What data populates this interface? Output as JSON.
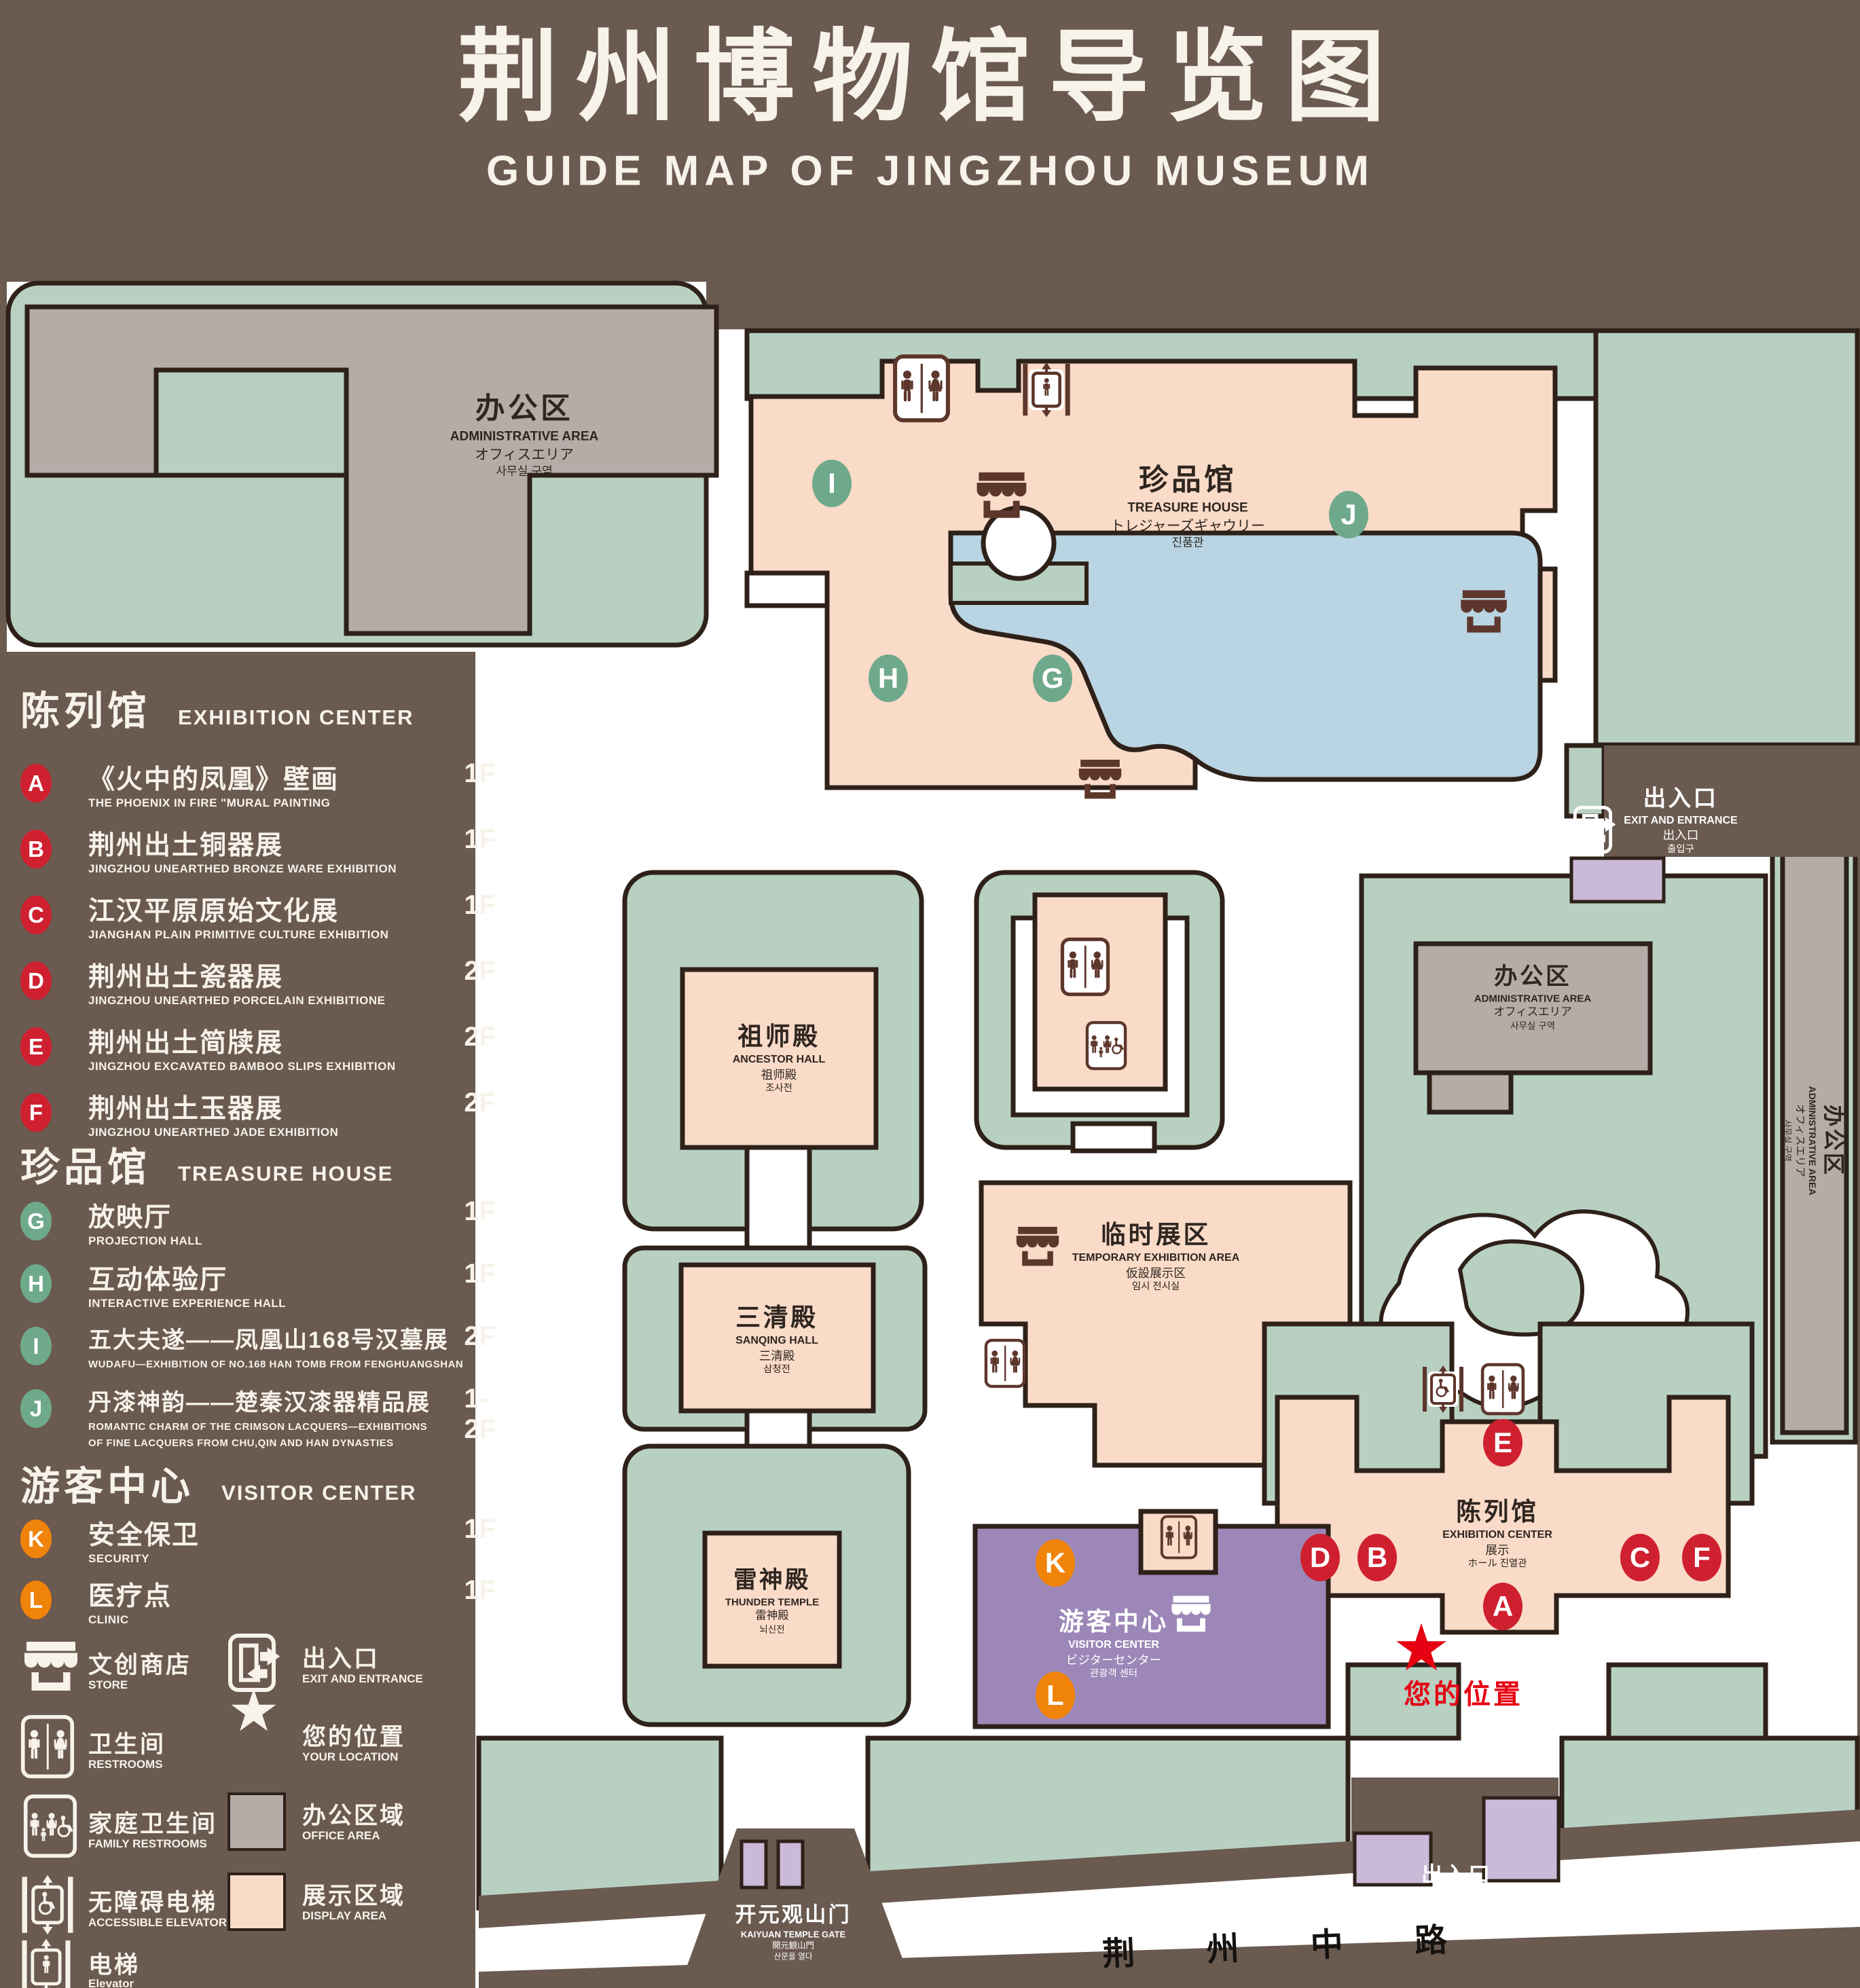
{
  "title": {
    "zh": "荆州博物馆导览图",
    "en": "GUIDE MAP OF JINGZHOU MUSEUM"
  },
  "colors": {
    "background": "#6a5a50",
    "map_green": "#b7d0c2",
    "display_area": "#f9dbc8",
    "office_area": "#b5aca8",
    "water": "#b9d4e2",
    "visitor_purple": "#9c87b8",
    "booth_purple": "#cbb9d8",
    "marker_red": "#cf2030",
    "marker_green": "#6fa98c",
    "marker_orange": "#f0830a",
    "location_red": "#e60012",
    "outline": "#2e2119"
  },
  "legend": {
    "sections": [
      {
        "zh": "陈列馆",
        "en": "EXHIBITION CENTER",
        "items": [
          {
            "letter": "A",
            "zh": "《火中的凤凰》壁画",
            "en": "THE PHOENIX IN FIRE \"MURAL PAINTING",
            "floor": "1F"
          },
          {
            "letter": "B",
            "zh": "荆州出土铜器展",
            "en": "JINGZHOU UNEARTHED BRONZE WARE EXHIBITION",
            "floor": "1F"
          },
          {
            "letter": "C",
            "zh": "江汉平原原始文化展",
            "en": "JIANGHAN PLAIN PRIMITIVE CULTURE EXHIBITION",
            "floor": "1F"
          },
          {
            "letter": "D",
            "zh": "荆州出土瓷器展",
            "en": "JINGZHOU UNEARTHED PORCELAIN EXHIBITIONE",
            "floor": "2F"
          },
          {
            "letter": "E",
            "zh": "荆州出土简牍展",
            "en": "JINGZHOU EXCAVATED BAMBOO SLIPS EXHIBITION",
            "floor": "2F"
          },
          {
            "letter": "F",
            "zh": "荆州出土玉器展",
            "en": "JINGZHOU UNEARTHED JADE EXHIBITION",
            "floor": "2F"
          }
        ]
      },
      {
        "zh": "珍品馆",
        "en": "TREASURE HOUSE",
        "items": [
          {
            "letter": "G",
            "zh": "放映厅",
            "en": "PROJECTION HALL",
            "floor": "1F"
          },
          {
            "letter": "H",
            "zh": "互动体验厅",
            "en": "INTERACTIVE EXPERIENCE HALL",
            "floor": "1F"
          },
          {
            "letter": "I",
            "zh": "五大夫遂——凤凰山168号汉墓展",
            "en": "WUDAFU—EXHIBITION OF NO.168 HAN TOMB FROM FENGHUANGSHAN",
            "floor": "2F"
          },
          {
            "letter": "J",
            "zh": "丹漆神韵——楚秦汉漆器精品展",
            "en": "ROMANTIC CHARM OF THE CRIMSON LACQUERS—EXHIBITIONS\nOF FINE LACQUERS FROM CHU,QIN AND HAN DYNASTIES",
            "floor": "1-2F"
          }
        ]
      },
      {
        "zh": "游客中心",
        "en": "VISITOR CENTER",
        "items": [
          {
            "letter": "K",
            "zh": "安全保卫",
            "en": "SECURITY",
            "floor": "1F"
          },
          {
            "letter": "L",
            "zh": "医疗点",
            "en": "CLINIC",
            "floor": "1F"
          }
        ]
      }
    ],
    "icons": [
      {
        "zh": "文创商店",
        "en": "STORE"
      },
      {
        "zh": "卫生间",
        "en": "RESTROOMS"
      },
      {
        "zh": "家庭卫生间",
        "en": "FAMILY RESTROOMS"
      },
      {
        "zh": "无障碍电梯",
        "en": "ACCESSIBLE ELEVATOR"
      },
      {
        "zh": "电梯",
        "en": "Elevator"
      },
      {
        "zh": "出入口",
        "en": "EXIT AND ENTRANCE"
      },
      {
        "zh": "您的位置",
        "en": "YOUR LOCATION"
      },
      {
        "zh": "办公区域",
        "en": "OFFICE AREA"
      },
      {
        "zh": "展示区域",
        "en": "DISPLAY AREA"
      }
    ]
  },
  "map": {
    "admin_area": {
      "zh": "办公区",
      "en": "ADMINISTRATIVE AREA",
      "jp": "オフィスエリア",
      "kr": "사무실 구역"
    },
    "treasure_house": {
      "zh": "珍品馆",
      "en": "TREASURE HOUSE",
      "jp": "トレジャーズギャウリー",
      "kr": "진품관"
    },
    "ancestor_hall": {
      "zh": "祖师殿",
      "en": "ANCESTOR HALL",
      "jp": "祖师殿",
      "kr": "조사전"
    },
    "sanqing_hall": {
      "zh": "三清殿",
      "en": "SANQING HALL",
      "jp": "三清殿",
      "kr": "삼청전"
    },
    "thunder_temple": {
      "zh": "雷神殿",
      "en": "THUNDER TEMPLE",
      "jp": "雷神殿",
      "kr": "뇌신전"
    },
    "temporary_exhibition": {
      "zh": "临时展区",
      "en": "TEMPORARY EXHIBITION AREA",
      "jp": "仮設展示区",
      "kr": "임시 전시실"
    },
    "visitor_center": {
      "zh": "游客中心",
      "en": "VISITOR CENTER",
      "jp": "ビジターセンター",
      "kr": "관광객 센터"
    },
    "exhibition_center": {
      "zh": "陈列馆",
      "en": "EXHIBITION CENTER",
      "jp": "展示",
      "kr": "ホール 진열관"
    },
    "exit": {
      "zh": "出入口",
      "en": "EXIT AND ENTRANCE",
      "zh2": "出入口",
      "kr": "출입구"
    },
    "gate": {
      "zh": "开元观山门",
      "en": "KAIYUAN TEMPLE GATE",
      "jp": "開元観山門",
      "kr": "산문을 열다"
    },
    "road": "荆 州 中 路",
    "your_location": "您的位置",
    "star_glyph": "★"
  }
}
